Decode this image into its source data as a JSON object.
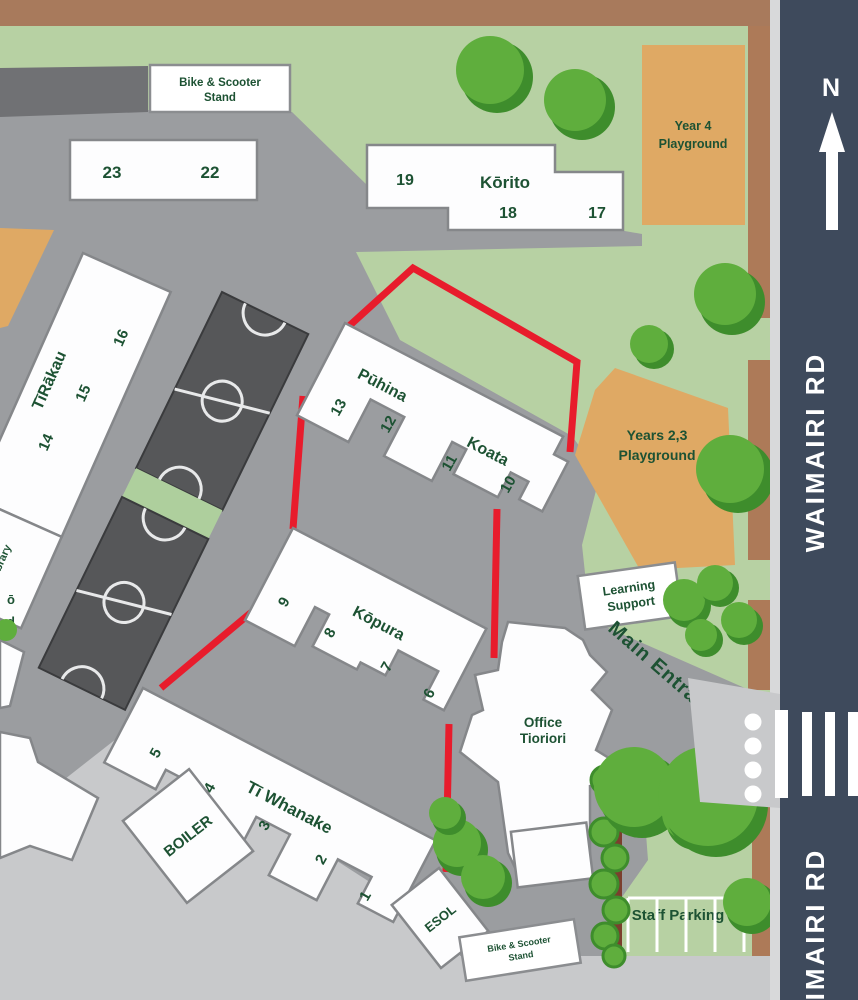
{
  "road": {
    "name": "WAIMAIRI RD",
    "compass": "N"
  },
  "signs": {
    "bike_stand": [
      "Bike & Scooter",
      "Stand"
    ],
    "learning_support": [
      "Learning",
      "Support"
    ],
    "staff_parking": "Staff Parking",
    "main_entrance": "Main Entrance",
    "boiler": "BOILER",
    "esol": "ESOL",
    "library": [
      "Te Tī",
      "Library"
    ],
    "partial_label": [
      "ō",
      "d"
    ]
  },
  "playgrounds": {
    "year4": [
      "Year 4",
      "Playground"
    ],
    "years23": [
      "Years 2,3",
      "Playground"
    ]
  },
  "buildings": {
    "b2322": {
      "numbers": [
        "23",
        "22"
      ]
    },
    "korito": {
      "name": "Kōrito",
      "numbers": [
        "19",
        "18",
        "17"
      ]
    },
    "tirakau": {
      "name": "TīRākau",
      "numbers": [
        "16",
        "15",
        "14"
      ]
    },
    "puhina": {
      "name": "Pūhina",
      "numbers": [
        "13",
        "12"
      ]
    },
    "koata": {
      "name": "Koata",
      "numbers": [
        "11",
        "10"
      ]
    },
    "kopura": {
      "name": "Kōpura",
      "numbers": [
        "9",
        "8",
        "7",
        "6"
      ]
    },
    "tiwhanake": {
      "name": "Tī Whanake",
      "numbers": [
        "5",
        "4",
        "3",
        "2",
        "1"
      ]
    },
    "office": {
      "name": [
        "Office",
        "Tioriori"
      ]
    }
  },
  "colors": {
    "road": "#3e4a5c",
    "curb": "#d8d9da",
    "berm_brown": "#ad7a58",
    "top_brown": "#a87a5c",
    "grass": "#b7d1a3",
    "ground": "#9b9da0",
    "ground_light": "#c8c9cb",
    "dark_wedge": "#707174",
    "court": "#565759",
    "court_gap": "#aecf9d",
    "playground_tan": "#dfa964",
    "route_red": "#e81c2c",
    "text_green": "#1d5233",
    "tree": "#5fae3d",
    "tree_dark": "#3e8d2c",
    "hedge_trunk": "#7b3f2e",
    "white": "#ffffff"
  }
}
